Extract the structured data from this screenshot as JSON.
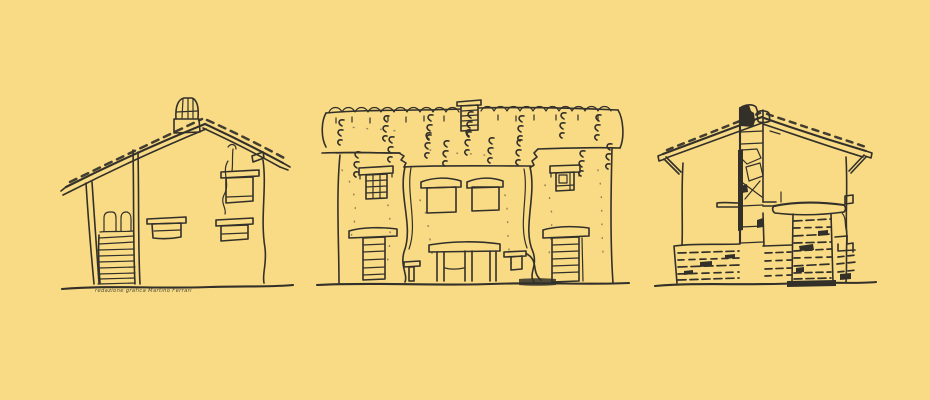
{
  "colors": {
    "background": "#F8DB84",
    "ink": "#33302A"
  },
  "caption": {
    "text": "redazione grafica Martino Ferrari"
  },
  "figures": [
    {
      "name": "stone house with external staircase, gable roof and chimney pot"
    },
    {
      "name": "long farmhouse with thatched stone roof band, two wings and central porch"
    },
    {
      "name": "house with tall central chimney stack and stone masonry base"
    }
  ]
}
